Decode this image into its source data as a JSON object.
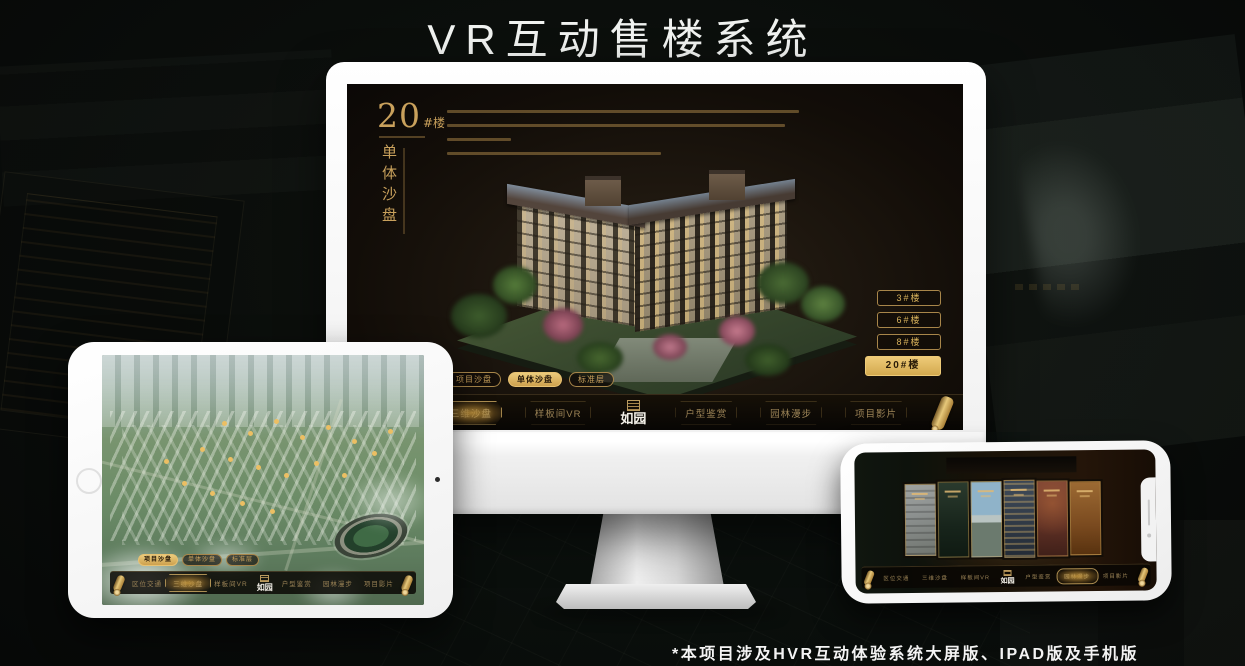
{
  "page": {
    "title": "VR互动售楼系统",
    "footnote": "*本项目涉及HVR互动体验系统大屏版、IPAD版及手机版"
  },
  "colors": {
    "gold": "#c9a15c",
    "gold_bright": "#e7c87a",
    "screen_bg": "#17100a",
    "navbar_bg": "#0b0906",
    "title_white": "#f0f2f0"
  },
  "logo": {
    "text": "如园",
    "icon": "seal-icon"
  },
  "nav": {
    "items": [
      "区位交通",
      "三维沙盘",
      "样板间VR",
      "户型鉴赏",
      "园林漫步",
      "项目影片"
    ],
    "end_icon": "scroll-icon"
  },
  "monitor": {
    "block_title_num": "20",
    "block_title_suffix": "#楼",
    "block_subtitle": "单体沙盘",
    "view_tabs": [
      "项目沙盘",
      "单体沙盘",
      "标准层"
    ],
    "active_tab": "单体沙盘",
    "floor_buttons": [
      "3#楼",
      "6#楼",
      "8#楼",
      "20#楼"
    ],
    "active_floor": "20#楼",
    "active_nav": "三维沙盘"
  },
  "ipad": {
    "view_tabs": [
      "项目沙盘",
      "单体沙盘",
      "标准层"
    ],
    "active_tab": "项目沙盘",
    "active_nav": "三维沙盘"
  },
  "phone": {
    "active_nav": "园林漫步"
  }
}
